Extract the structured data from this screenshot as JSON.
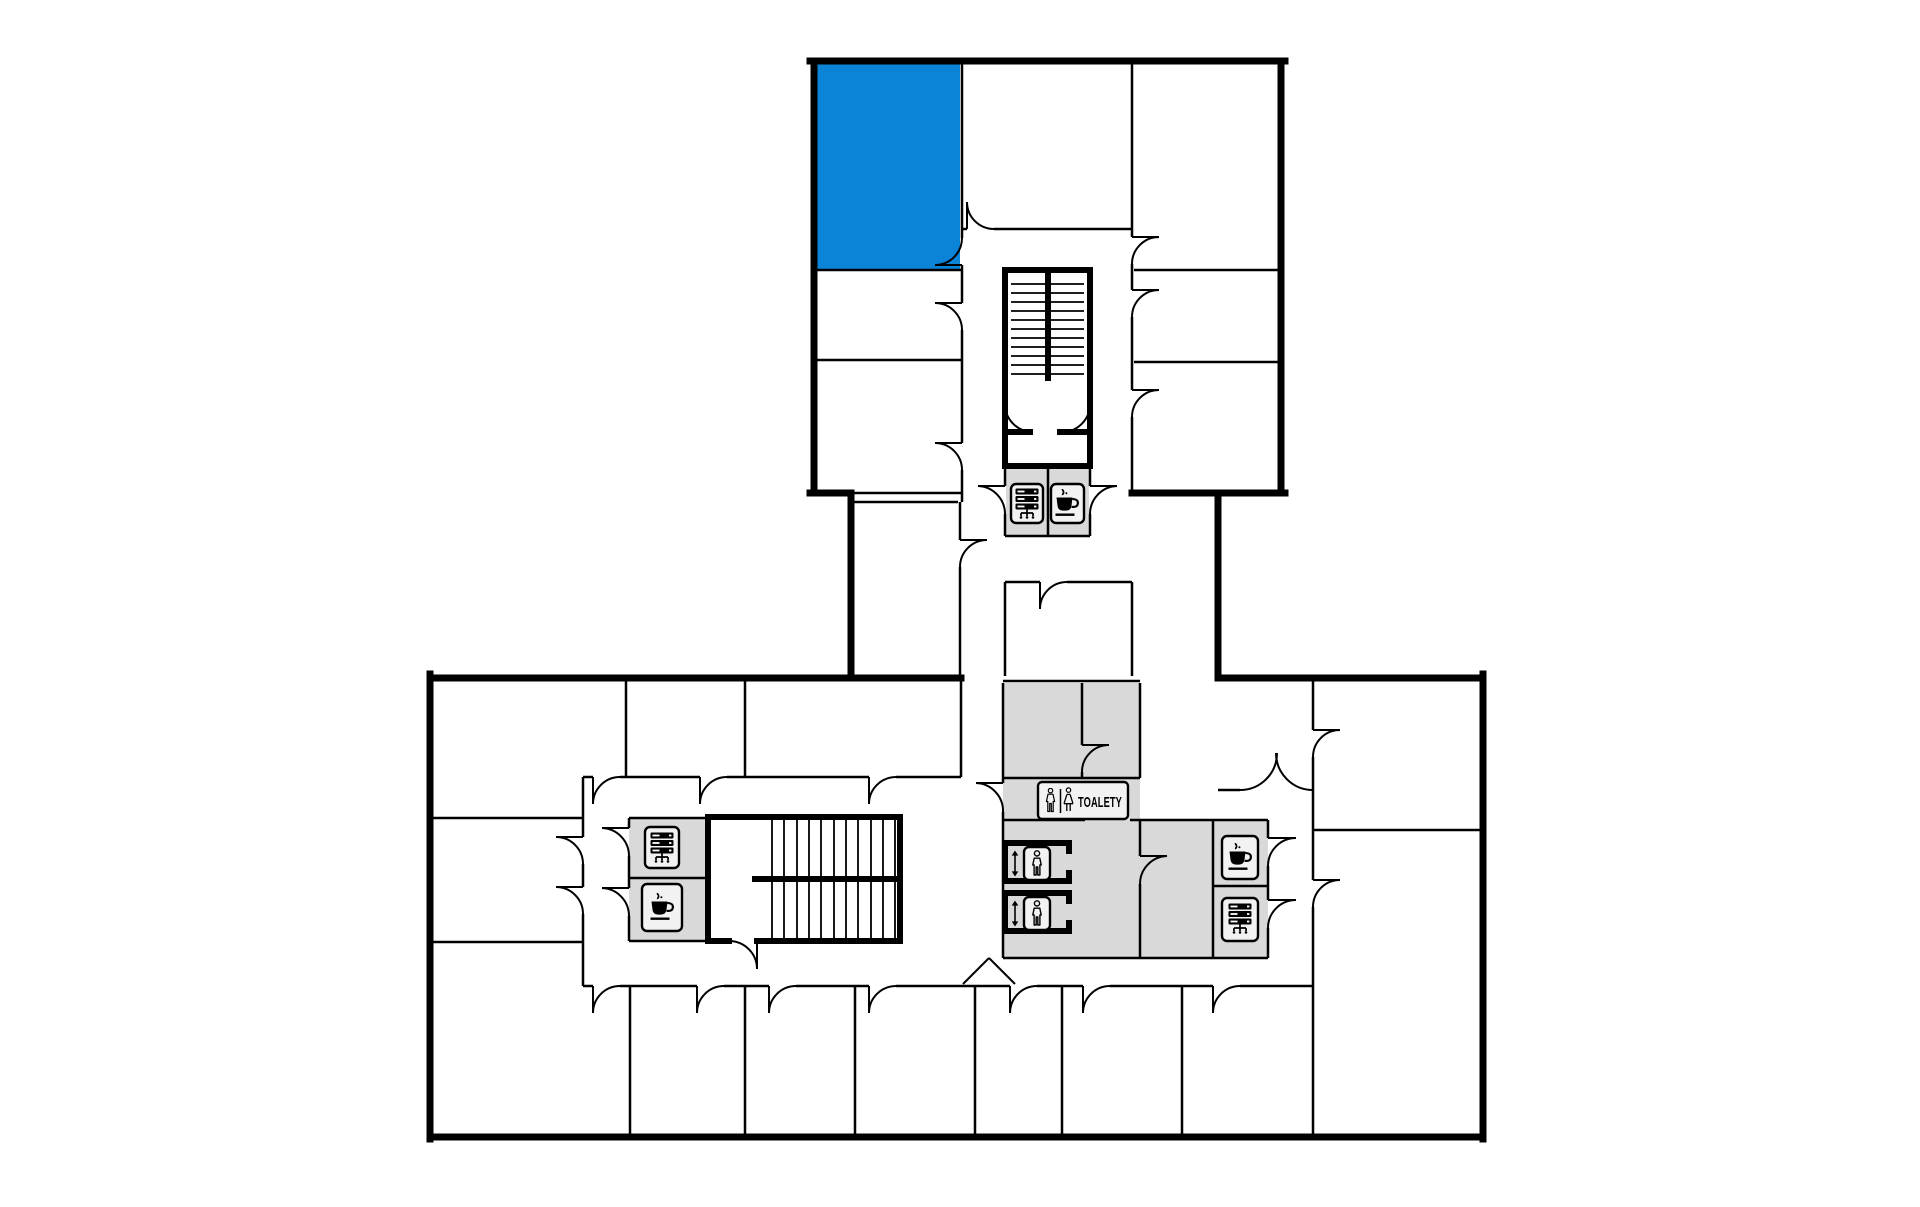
{
  "plan": {
    "toilets_label": "TOALETY"
  },
  "colors": {
    "highlight": "#0b84d8",
    "service": "#d9d9d9",
    "sign": "#f2f2f2",
    "wall": "#000000",
    "bg": "#ffffff"
  },
  "icons": {
    "toilets_sign": [
      "man-icon",
      "woman-icon"
    ],
    "elevator_sign": [
      "up-down-arrow-icon",
      "elevator-person-icon"
    ],
    "coffee_point": "coffee-cup-icon",
    "server_room": "server-rack-icon",
    "stairs": "stair-treads"
  },
  "signs": [
    {
      "id": "upper-core-server",
      "icon": "server-rack-icon"
    },
    {
      "id": "upper-core-coffee",
      "icon": "coffee-cup-icon"
    },
    {
      "id": "left-core-server",
      "icon": "server-rack-icon"
    },
    {
      "id": "left-core-coffee",
      "icon": "coffee-cup-icon"
    },
    {
      "id": "elevator-1",
      "icon": "elevator-person-icon"
    },
    {
      "id": "elevator-2",
      "icon": "elevator-person-icon"
    },
    {
      "id": "right-core-coffee",
      "icon": "coffee-cup-icon"
    },
    {
      "id": "right-core-server",
      "icon": "server-rack-icon"
    },
    {
      "id": "toilets",
      "icon": "man-woman-icons",
      "label": "TOALETY"
    }
  ]
}
